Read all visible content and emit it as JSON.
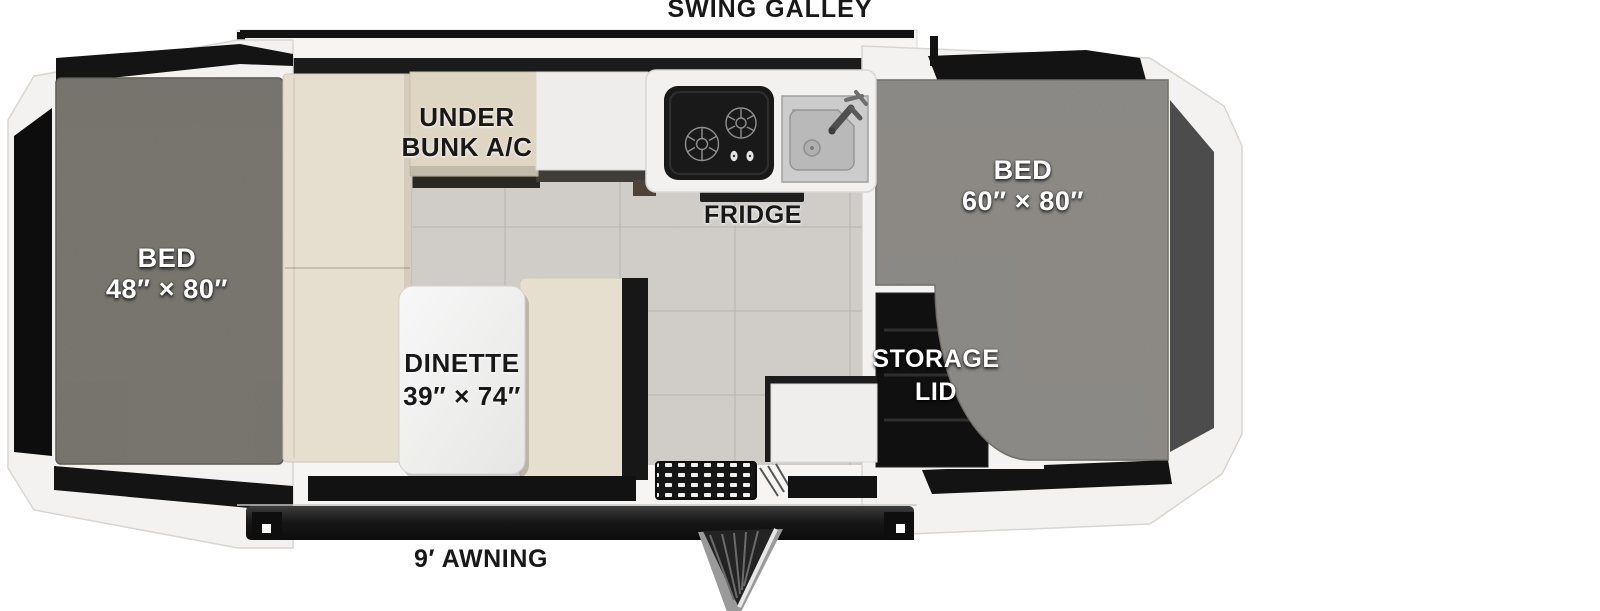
{
  "floorplan": {
    "top_label": "SWING GALLEY",
    "awning_label": "9′ AWNING",
    "areas": {
      "bed_left": {
        "name": "BED",
        "size": "48″ × 80″"
      },
      "bed_right": {
        "name": "BED",
        "size": "60″ × 80″"
      },
      "dinette": {
        "name": "DINETTE",
        "size": "39″ × 74″"
      },
      "under_bunk_ac": {
        "line1": "UNDER",
        "line2": "BUNK A/C"
      },
      "fridge": {
        "name": "FRIDGE"
      },
      "storage_lid": {
        "line1": "STORAGE",
        "line2": "LID"
      }
    },
    "fixtures": {
      "stove": "two-burner-stove-icon",
      "sink": "sink-faucet-icon",
      "entry_step": "entry-step-grate-icon",
      "door": "fold-down-door-step-icon",
      "awning_rail": "awning-rail-icon"
    },
    "colors": {
      "body_white": "#f5f4f2",
      "trim_black": "#161616",
      "mattress_left": "#7a746b",
      "mattress_right": "#8f8b84",
      "cushion_beige": "#e6dfcf",
      "cabinet_beige": "#ded5c2",
      "floor_gray": "#cbc8c3",
      "tent_panel_gray": "#4c4c4c",
      "label_dark": "#1a1a1a",
      "label_light": "#ffffff"
    }
  }
}
